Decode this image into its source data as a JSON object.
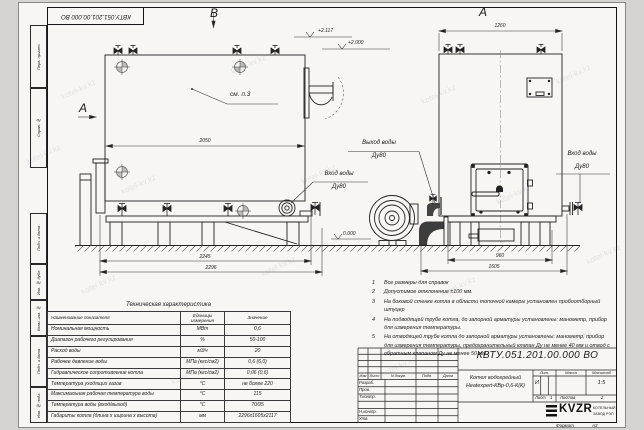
{
  "watermark": "kotel-kv.kz",
  "frame": {
    "stamp_top": "КВТУ.051.201.00.000 ВО",
    "side_labels": [
      "Перв. примен.",
      "Справ. №",
      "Подп. и дата",
      "Инв. № дубл.",
      "Взам. инв. №",
      "Подп. и дата",
      "Инв. № подл."
    ],
    "format_label": "Формат",
    "format_value": "А3"
  },
  "labels": {
    "view_b": "В",
    "view_a": "А",
    "section_a": "А",
    "see_note": "см. п.3"
  },
  "elevations": {
    "top1": "+2.117",
    "top2": "+2.000",
    "ground": "0.000"
  },
  "dimensions": {
    "view_b_width": "2050",
    "view_b_len_inner": "2245",
    "view_b_len_outer": "2296",
    "view_a_width_top": "1260",
    "view_a_base": "960",
    "view_a_overall": "1605"
  },
  "pipe_labels": [
    {
      "line1": "Выход воды",
      "line2": "Ду80"
    },
    {
      "line1": "Вход воды",
      "line2": "Ду80"
    },
    {
      "line1": "Вход воды",
      "line2": "Ду80"
    }
  ],
  "notes": {
    "items": [
      {
        "num": "1",
        "text": "Все размеры для справок"
      },
      {
        "num": "2",
        "text": "Допустимое отклонение ±100 мм."
      },
      {
        "num": "3",
        "text": "На боковой стенке котла в области топочной камеры установлен пробоотборный штуцер"
      },
      {
        "num": "4",
        "text": "На подводящей трубе котла, до запорной арматуры установлены: манометр, прибор для измерения температуры."
      },
      {
        "num": "5",
        "text": "На отводящей трубе котла до запорной арматуры установлены: манометр, прибор для измерения температуры, предохранительный клапан Ду не менее 40 мм и отвод с обратным клапаном Ду не менее 50 мм."
      }
    ]
  },
  "spec_table": {
    "title": "Техническая характеристика",
    "col_name": "Наименование показателя",
    "col_units": "Единицы измерения",
    "col_value": "Значение",
    "rows": [
      {
        "name": "Номинальная мощность",
        "units": "МВт",
        "value": "0,6"
      },
      {
        "name": "Диапазон рабочего регулирования",
        "units": "%",
        "value": "50-100"
      },
      {
        "name": "Расход воды",
        "units": "м3/ч",
        "value": "20"
      },
      {
        "name": "Рабочее давление воды",
        "units": "МПа (кгс/см2)",
        "value": "0,6 (6,0)"
      },
      {
        "name": "Гидравлическое сопротивление котла",
        "units": "МПа (кгс/см2)",
        "value": "0,06 (0,6)"
      },
      {
        "name": "Температура уходящих газов",
        "units": "°С",
        "value": "не более 220"
      },
      {
        "name": "Максимальная рабочая температура воды",
        "units": "°С",
        "value": "115"
      },
      {
        "name": "Температура воды (вход/выход)",
        "units": "°С",
        "value": "70/95"
      },
      {
        "name": "Габариты котла (длина х ширина х высота)",
        "units": "мм",
        "value": "2296х1605х2117"
      }
    ]
  },
  "title_block": {
    "doc_number": "КВТУ.051.201.00.000  ВО",
    "product_line1": "Котел водогрейный",
    "product_line2": "Heatexpert-КВр-0,6-К(К)",
    "lit_header": "Лит.",
    "mass_header": "Масса",
    "scale_header": "Масштаб",
    "lit_value": "И",
    "scale_value": "1:5",
    "sheet_label": "Лист",
    "sheet_value": "1",
    "sheets_label": "Листов",
    "sheets_value": "2",
    "sig_headers": {
      "izm": "Изм",
      "list": "Лист",
      "doc": "N докум.",
      "podp": "Подп.",
      "data": "Дата"
    },
    "sig_rows": [
      "Разраб.",
      "Пров.",
      "Т.контр.",
      "",
      "Н.контр.",
      "Утв."
    ],
    "logo_text": "KVZR",
    "logo_sub1": "КОТЕЛЬНЫЙ",
    "logo_sub2": "ЗАВОД РЭП"
  }
}
